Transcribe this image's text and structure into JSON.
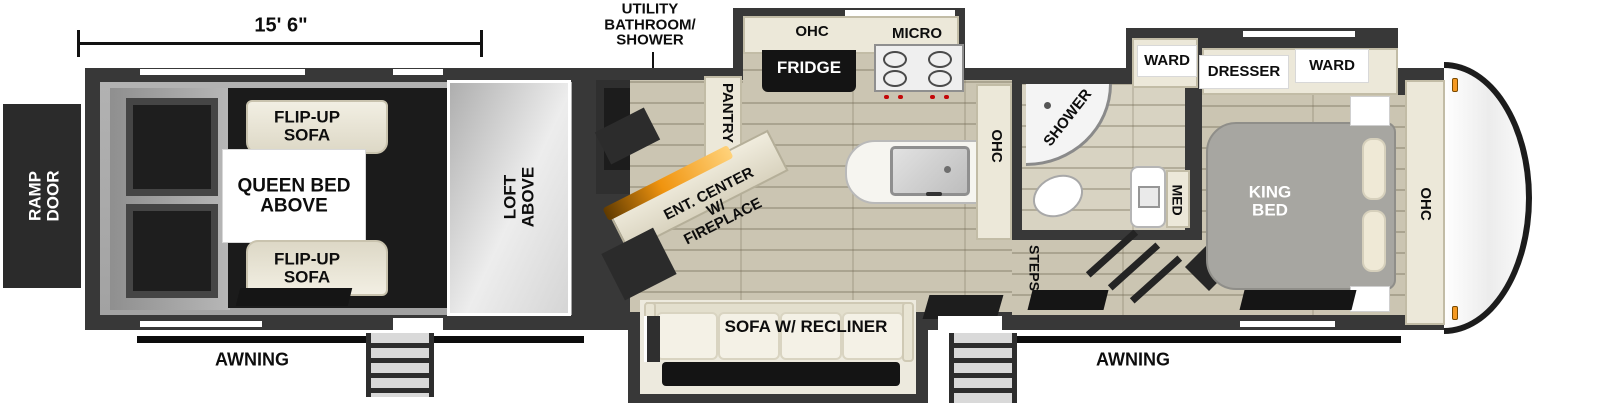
{
  "exterior": {
    "ramp_door": "RAMP DOOR",
    "garage_length": "15' 6\"",
    "awning_left": "AWNING",
    "awning_right": "AWNING"
  },
  "garage": {
    "flip_up_sofa_top": "FLIP-UP SOFA",
    "queen_bed": "QUEEN BED ABOVE",
    "flip_up_sofa_bottom": "FLIP-UP SOFA",
    "loft": "LOFT ABOVE"
  },
  "utility": {
    "label": "UTILITY BATHROOM/ SHOWER"
  },
  "kitchen": {
    "pantry": "PANTRY",
    "ohc_top": "OHC",
    "micro": "MICRO",
    "fridge": "FRIDGE",
    "ent_center": "ENT. CENTER W/ FIREPLACE",
    "ohc_side": "OHC",
    "sofa": "SOFA W/ RECLINER",
    "steps": "STEPS"
  },
  "bathroom": {
    "shower": "SHOWER",
    "med": "MED",
    "ward": "WARD"
  },
  "bedroom": {
    "dresser": "DRESSER",
    "ward": "WARD",
    "king_bed": "KING BED",
    "ohc": "OHC"
  },
  "colors": {
    "wall": "#383838",
    "floor": "#cbc5b2",
    "cabinet": "#ece8d9",
    "garage_floor": "#1b1b1b",
    "fireplace_accent": "#f0940f",
    "clearance_light": "#f59a23",
    "bed": "#a7a6a1",
    "label_plate": "#ffffff"
  }
}
